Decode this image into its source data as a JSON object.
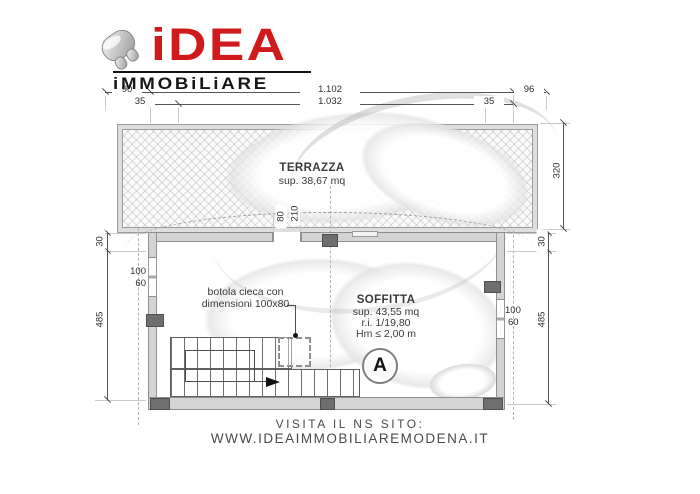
{
  "logo": {
    "brand": "iDEA",
    "subtitle": "iMMOBiLiARE",
    "brand_color": "#d01a1b"
  },
  "footer": {
    "line1": "VISITA IL NS SITO:",
    "line2": "WWW.IDEAIMMOBILIAREMODENA.IT"
  },
  "colors": {
    "wall_gray": "#d4d4d4",
    "pillar_gray": "#6e6e6e",
    "dimension_text": "#2e2e2e"
  },
  "plan": {
    "terrazza": {
      "title": "TERRAZZA",
      "area": "sup. 38,67 mq"
    },
    "soffitta": {
      "title": "SOFFITTA",
      "area": "sup. 43,55 mq",
      "ratio": "r.i. 1/19,80",
      "height": "Hm ≤ 2,00 m",
      "badge": "A"
    },
    "botola": {
      "line1": "botola cieca con",
      "line2": "dimensioni 100x80"
    },
    "dims": {
      "d90": "90",
      "d1102": "1.102",
      "d96": "96",
      "d35l": "35",
      "d1032": "1.032",
      "d35r": "35",
      "d320": "320",
      "d30l": "30",
      "d485l": "485",
      "d30r": "30",
      "d485r": "485",
      "door_w": "80",
      "door_h": "210",
      "win_left_w": "100",
      "win_left_h": "60",
      "win_right_w": "100",
      "win_right_h": "60"
    }
  }
}
